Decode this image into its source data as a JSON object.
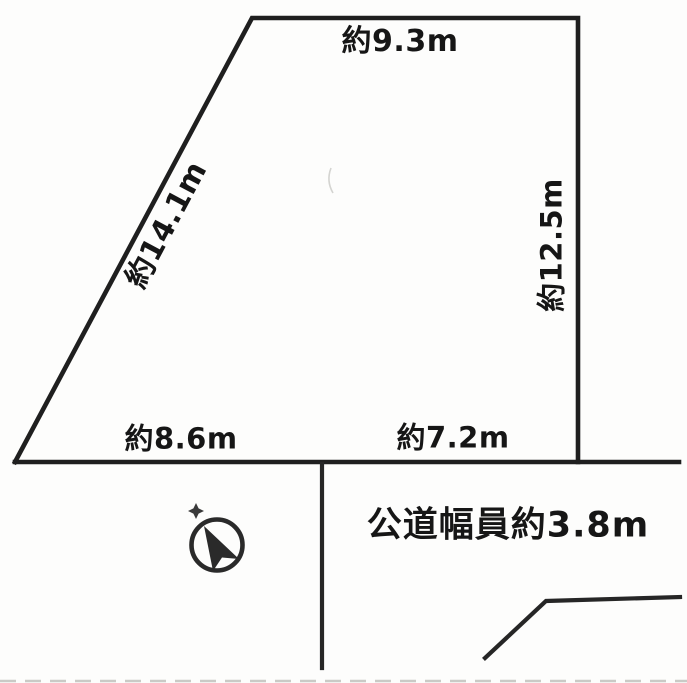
{
  "diagram": {
    "type": "land-plot-survey",
    "labels": {
      "top_edge": "約9.3m",
      "left_edge": "約14.1m",
      "right_edge": "約12.5m",
      "bottom_left_edge": "約8.6m",
      "bottom_right_edge": "約7.2m",
      "road": "公道幅員約3.8m"
    },
    "icons": {
      "compass": "north-arrow-icon",
      "north_marker": "star"
    },
    "colors": {
      "line": "#1f1f1f",
      "text": "#161616",
      "background": "#fdfdfc",
      "scan_noise": "#b9b9b5"
    }
  }
}
